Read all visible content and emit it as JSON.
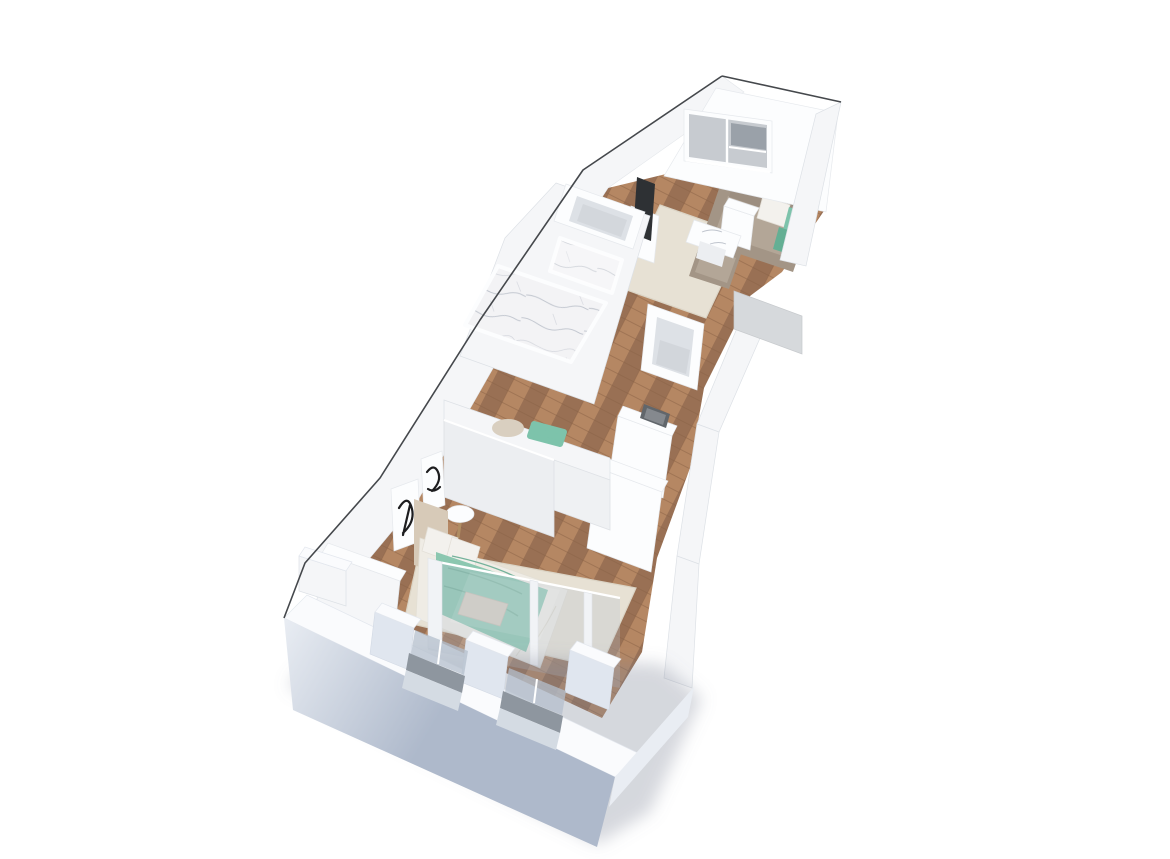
{
  "title": "3D dollhouse-style floor plan render of a narrow one-bedroom apartment, viewed diagonally from above on a white background",
  "dimensions": {
    "width": 1170,
    "height": 859
  },
  "palette": {
    "bg": "#ffffff",
    "outline": "#45484c",
    "wall_bright": "#fcfdfe",
    "wall_white": "#f5f6f8",
    "wall_shade": "#eceef1",
    "wall_dark": "#dde1e6",
    "ext_face": "#aeb9cb",
    "ext_face_light": "#e9edf3",
    "ext_top": "#fafbfd",
    "pillar_face": "#e0e6ef",
    "wood": "#a87b5b",
    "wood_dark": "#997054",
    "wood_light": "#b78a64",
    "wood_seam": "#8a6246",
    "rug": "#e7e1d4",
    "rug_edge": "#dbd4c5",
    "sofa": "#a39586",
    "sofa_light": "#b3a697",
    "sofa_dark": "#9c8e80",
    "pillow_white": "#f3f1ed",
    "teal": "#7dc3ab",
    "teal_dark": "#64af94",
    "blanket": "#8cc7b0",
    "blanket_dark": "#74b29b",
    "sheet": "#efece5",
    "headboard": "#d7cab8",
    "pillow_gray": "#d2cabc",
    "marble_base": "#f3f3f5",
    "marble_vein": "#bfc4cd",
    "tv": "#2e3134",
    "glass": "rgba(186,197,210,0.30)",
    "glass_post": "#f1f3f6",
    "pane": "#c7cbd0",
    "pane_dark": "#9aa1a9",
    "track": "#8e969f",
    "sill": "#d4dbe3",
    "door_panel": "#d6d9dc",
    "art_ink": "#1d1d1f",
    "shadow": "rgba(125,133,148,0.32)"
  },
  "scene": {
    "view": "isometric-perspective, unit runs diagonally from living room (top right) to bedroom (bottom left)",
    "rooms": [
      {
        "name": "living-room",
        "position": "top-right",
        "contents": [
          "window-with-gray-panes",
          "sectional-sofa-taupe",
          "white-throw-pillow",
          "two-teal-throw-pillows",
          "white-cube-side-table",
          "marble-top-coffee-table",
          "wall-tv",
          "beige-area-rug",
          "wood-floor"
        ]
      },
      {
        "name": "bathroom",
        "position": "middle-left",
        "contents": [
          "marble-walk-in-shower",
          "open-storage-shelf"
        ]
      },
      {
        "name": "hallway",
        "position": "middle",
        "contents": [
          "wood-floor",
          "utility-shaft-box",
          "gray-door-panel"
        ]
      },
      {
        "name": "kitchenette",
        "position": "middle-right",
        "contents": [
          "counter-with-dark-sink",
          "white-dresser"
        ]
      },
      {
        "name": "closet-nook",
        "position": "center-lower",
        "contents": [
          "sliding-wardrobe-panels",
          "teal-chair",
          "beige-chair"
        ]
      },
      {
        "name": "bedroom",
        "position": "bottom-left",
        "contents": [
          "double-bed",
          "teal-blanket",
          "cream-sheets",
          "beige-headboard",
          "two-white-pillows",
          "gray-accent-pillow",
          "round-white-side-table",
          "two-black-white-art-frames",
          "beige-area-rug",
          "glass-partition-wall"
        ]
      }
    ],
    "exterior": [
      "thin-dark-ceiling-outline-upper-left",
      "thick-blue-gray-exterior-walls-bottom",
      "two-window-openings-with-gray-tracks",
      "white-wall-pillars",
      "soft-ground-shadow"
    ]
  }
}
